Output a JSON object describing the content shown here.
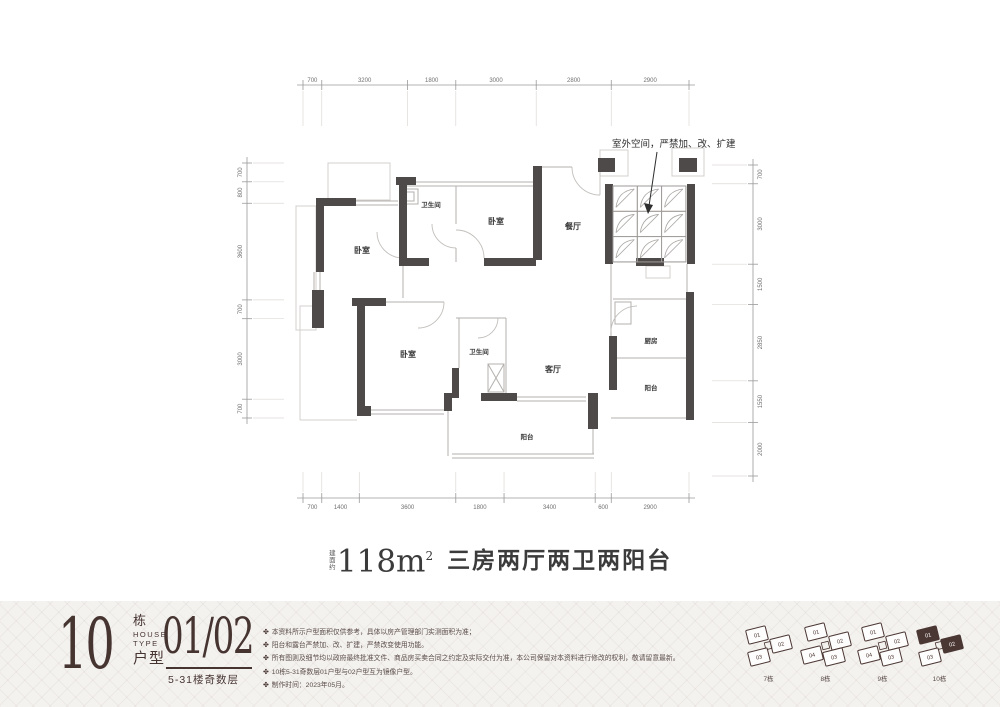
{
  "colors": {
    "accent": "#463431",
    "wall": "#4e4a49",
    "band_bg": "#f4f2ef"
  },
  "plan": {
    "annotation": "室外空间，严禁加、改、扩建",
    "rooms": [
      "卧室",
      "卫生间",
      "卧室",
      "餐厅",
      "卧室",
      "卫生间",
      "客厅",
      "厨房",
      "阳台",
      "阳台"
    ],
    "dimensions": {
      "top": [
        "700",
        "3200",
        "1800",
        "3000",
        "2800",
        "2900"
      ],
      "bottom": [
        "700",
        "1400",
        "3600",
        "1800",
        "3400",
        "600",
        "2900"
      ],
      "left": [
        "700",
        "800",
        "3600",
        "700",
        "3000",
        "700"
      ],
      "right": [
        "700",
        "3000",
        "1500",
        "2850",
        "1550",
        "2000"
      ]
    }
  },
  "title": {
    "area_prefix": "建面约",
    "area": "118m",
    "area_sup": "2",
    "descriptor": "三房两厅两卫两阳台"
  },
  "unit_info": {
    "building_number": "10",
    "building_suffix": "栋",
    "house_label": "HOUSE",
    "type_label": "TYPE",
    "type_cn": "户型",
    "unit_numbers": "01/02",
    "floors": "5-31楼奇数层"
  },
  "disclaimer": {
    "bullet": "✤",
    "items": [
      "本资料所示户型面积仅供参考，具体以房产管理部门实测面积为准；",
      "阳台和露台严禁加、改、扩建，严禁改变使用功能。",
      "所有图则及细节均以政府最终批准文件、商品房买卖合同之约定及实际交付为准，本公司保留对本资料进行修改的权利，敬请留意最新。",
      "10栋5-31奇数层01户型与02户型互为镜像户型。",
      "制作时间：2023年05月。"
    ]
  },
  "site_map": {
    "buildings": [
      {
        "name": "7栋",
        "units": [
          {
            "no": "01",
            "active": false
          },
          {
            "no": "02",
            "active": false
          },
          {
            "no": "03",
            "active": false
          }
        ]
      },
      {
        "name": "8栋",
        "units": [
          {
            "no": "01",
            "active": false
          },
          {
            "no": "02",
            "active": false
          },
          {
            "no": "03",
            "active": false
          },
          {
            "no": "04",
            "active": false
          }
        ]
      },
      {
        "name": "9栋",
        "units": [
          {
            "no": "01",
            "active": false
          },
          {
            "no": "02",
            "active": false
          },
          {
            "no": "03",
            "active": false
          },
          {
            "no": "04",
            "active": false
          }
        ]
      },
      {
        "name": "10栋",
        "units": [
          {
            "no": "01",
            "active": true
          },
          {
            "no": "02",
            "active": true
          },
          {
            "no": "03",
            "active": false
          }
        ]
      }
    ]
  }
}
